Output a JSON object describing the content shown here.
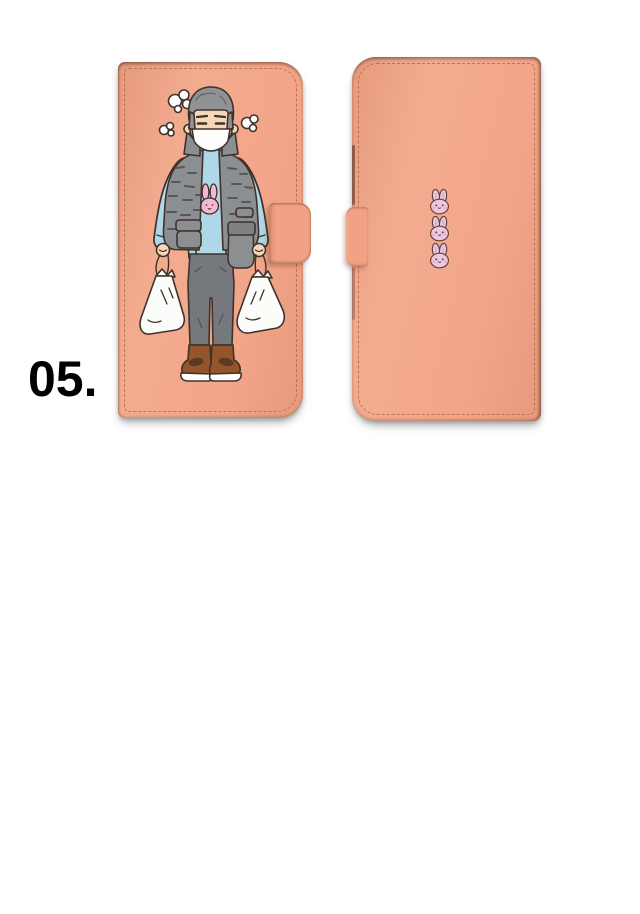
{
  "page": {
    "item_number": "05.",
    "background_color": "#ffffff"
  },
  "product": {
    "front_case": {
      "name": "flip wallet phone case - front cover",
      "illustration": "elderly man in face mask and quilted vest carrying two plastic shopping bags",
      "details": [
        "stitched border",
        "clasp strap on right edge"
      ]
    },
    "back_case": {
      "name": "flip wallet phone case - back cover",
      "illustration": "three pink bunny faces stacked vertically",
      "bunny_count": 3,
      "details": [
        "stitched border",
        "clasp strap side view on left edge"
      ]
    }
  },
  "colors": {
    "case": "#F2A284",
    "stitch": "#B5653F",
    "outline": "#3F322A",
    "skin": "#F6D7B8",
    "hair": "#909294",
    "hair-stroke": "#63666A",
    "mask": "#FDFDFD",
    "vest": "#8C8F92",
    "vest-detail": "#54575B",
    "vest-flap": "#7E8184",
    "shirt": "#AED7E8",
    "shirt-shade": "#7AAFC9",
    "bunny-shirt": "#F3B9D4",
    "pants": "#75797D",
    "pants-crease": "#53575B",
    "shoe": "#95552B",
    "shoe-lace": "#5C3A22",
    "bag": "#FCFCFB",
    "back-bunny": "#EBC7E0",
    "back-bunny-ear-line": "#C49BC2",
    "back-bunny-face": "#5F4238",
    "back-bunny-cheek": "#F0A6C5"
  }
}
